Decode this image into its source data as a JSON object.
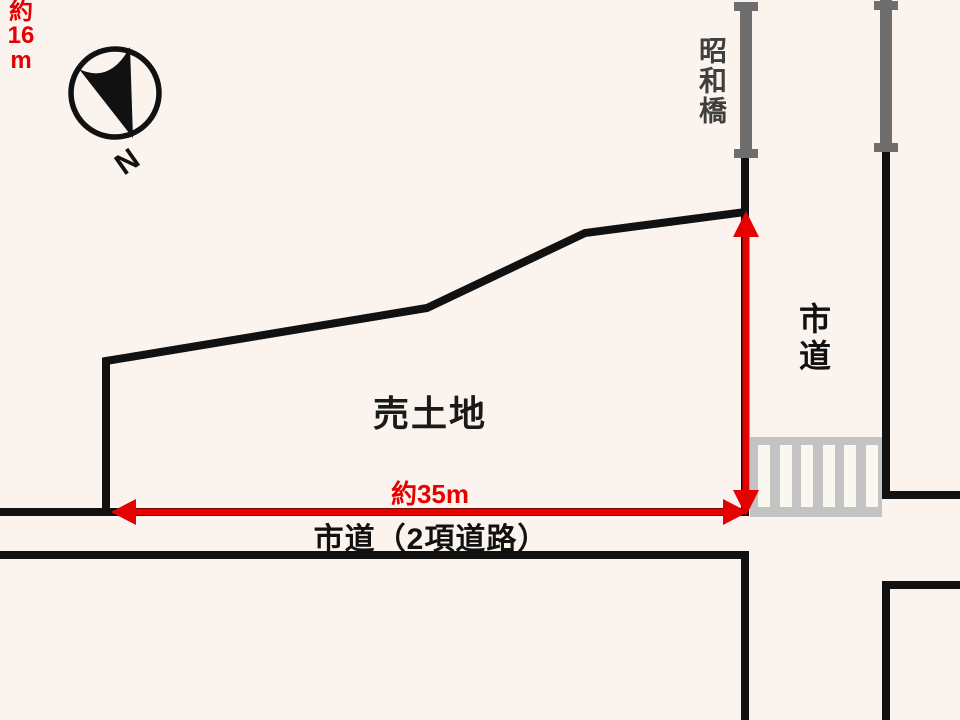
{
  "compass": {
    "north_label": "N"
  },
  "bridge": {
    "name": "昭和橋"
  },
  "roads": {
    "right_road": "市道",
    "bottom_road": "市道（2項道路）"
  },
  "plot": {
    "label": "売土地"
  },
  "dimensions": {
    "width": "約35m",
    "depth": "約16m",
    "depth_parts": {
      "prefix": "約",
      "value": "16",
      "unit": "m"
    }
  },
  "colors": {
    "background": "#fbf4ee",
    "outline_black": "#111111",
    "dimension_red": "#e60000",
    "bridge_railing_gray": "#6e6e6e",
    "crosswalk_gray": "#c3c3c3",
    "crosswalk_stripe": "#faf6f0",
    "bridge_label_gray": "#3f3f3f"
  }
}
